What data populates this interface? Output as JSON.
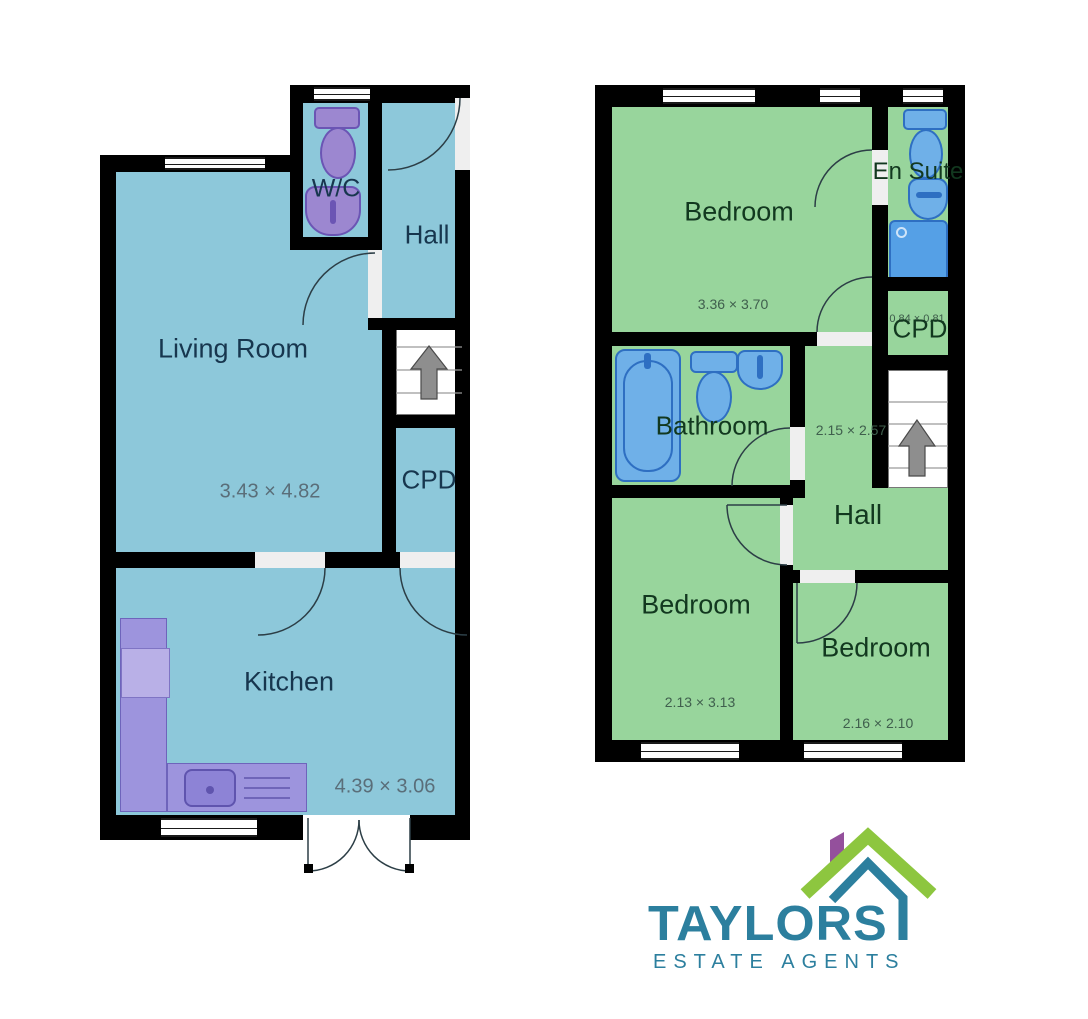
{
  "floorplan": {
    "ground_floor": {
      "wc_label": "W/C",
      "hall_label": "Hall",
      "living_room_label": "Living Room",
      "living_room_dims": "3.43 × 4.82",
      "cpd_label": "CPD",
      "kitchen_label": "Kitchen",
      "kitchen_dims": "4.39 × 3.06"
    },
    "first_floor": {
      "bedroom1_label": "Bedroom",
      "bedroom1_dims": "3.36 × 3.70",
      "en_suite_label": "En Suite",
      "cpd_label": "CPD",
      "cpd_dims": "0.84 × 0.81",
      "bathroom_label": "Bathroom",
      "hall_label": "Hall",
      "hall_dims": "2.15 × 2.57",
      "bedroom2_label": "Bedroom",
      "bedroom2_dims": "2.13 × 3.13",
      "bedroom3_label": "Bedroom",
      "bedroom3_dims": "2.16 × 2.10"
    }
  },
  "logo": {
    "name": "TAYLORS",
    "tagline": "ESTATE AGENTS"
  },
  "colors": {
    "ground_floor_fill": "#8dc8da",
    "first_floor_fill": "#98d59c",
    "ground_fixture_fill": "#9c87d0",
    "first_fixture_fill": "#6fb0e8",
    "wall": "#000000",
    "logo_teal": "#2c7f9e",
    "logo_green": "#8dc63f",
    "logo_purple": "#94509c"
  }
}
